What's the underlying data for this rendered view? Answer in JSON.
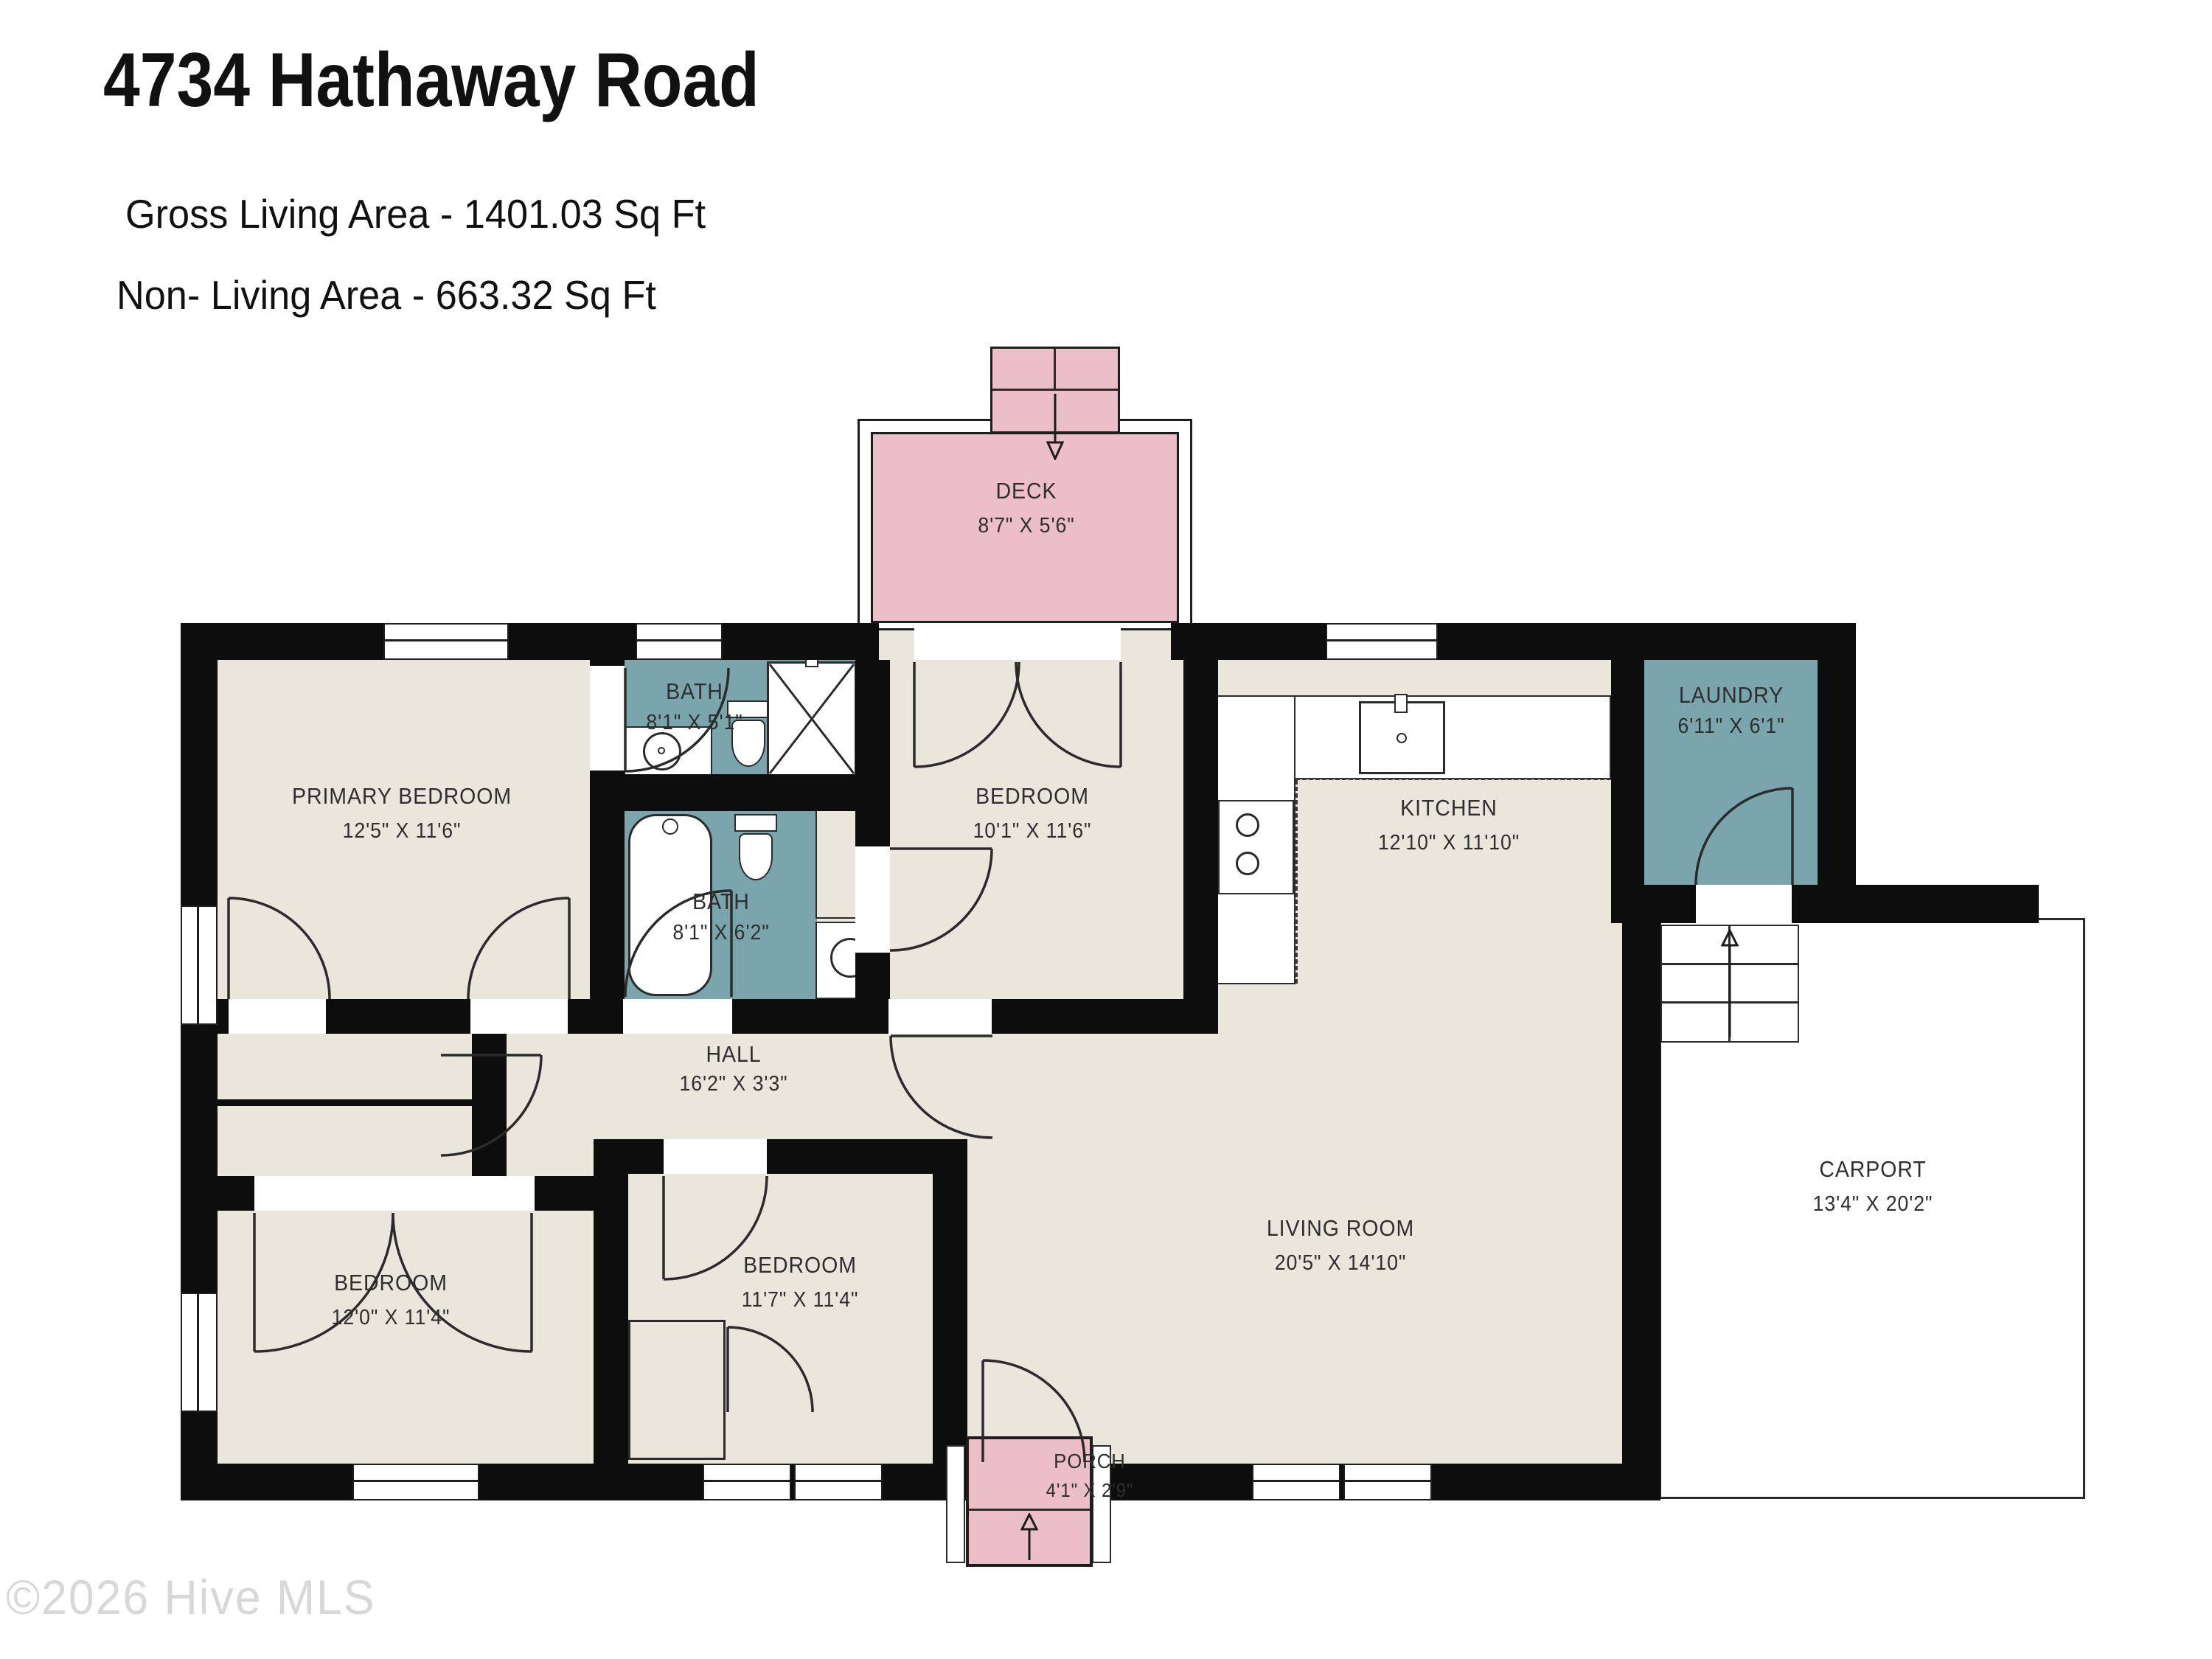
{
  "header": {
    "title": "4734 Hathaway Road",
    "gross_living": "Gross Living Area - 1401.03 Sq Ft",
    "non_living": "Non- Living Area - 663.32 Sq Ft"
  },
  "watermark": "©2026 Hive MLS",
  "colors": {
    "floor": "#e9e7dc",
    "wet": "#7aa5ad",
    "outdoor": "#ecbec7",
    "wall": "#0d0d0d",
    "line": "#2b2b2b",
    "watermark": "#d8d8d8"
  },
  "rooms": {
    "primary_bedroom": {
      "name": "PRIMARY BEDROOM",
      "dims": "12'5\" X 11'6\""
    },
    "bath_top": {
      "name": "BATH",
      "dims": "8'1\" X 5'1\""
    },
    "bedroom_ne": {
      "name": "BEDROOM",
      "dims": "10'1\" X 11'6\""
    },
    "kitchen": {
      "name": "KITCHEN",
      "dims": "12'10\" X 11'10\""
    },
    "laundry": {
      "name": "LAUNDRY",
      "dims": "6'11\" X 6'1\""
    },
    "bath_mid": {
      "name": "BATH",
      "dims": "8'1\" X 6'2\""
    },
    "hall": {
      "name": "HALL",
      "dims": "16'2\" X 3'3\""
    },
    "bedroom_sw": {
      "name": "BEDROOM",
      "dims": "12'0\" X 11'4\""
    },
    "bedroom_s": {
      "name": "BEDROOM",
      "dims": "11'7\" X 11'4\""
    },
    "living_room": {
      "name": "LIVING ROOM",
      "dims": "20'5\" X 14'10\""
    },
    "carport": {
      "name": "CARPORT",
      "dims": "13'4\" X 20'2\""
    },
    "deck": {
      "name": "DECK",
      "dims": "8'7\" X 5'6\""
    },
    "porch": {
      "name": "PORCH",
      "dims": "4'1\" X 2'9\""
    }
  }
}
